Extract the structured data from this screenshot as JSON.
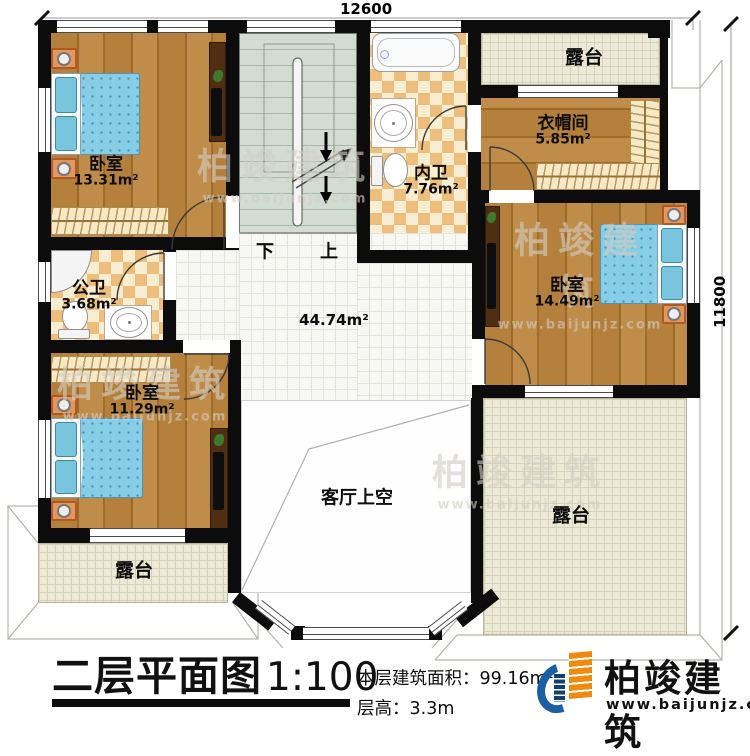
{
  "dimensions": {
    "width": "12600",
    "height": "11800"
  },
  "stairs": {
    "down": "下",
    "up": "上"
  },
  "rooms": {
    "bedroom_tl": {
      "name": "卧室",
      "area": "13.31m²"
    },
    "bath_inner": {
      "name": "内卫",
      "area": "7.76m²"
    },
    "terrace_top": {
      "name": "露台"
    },
    "cloakroom": {
      "name": "衣帽间",
      "area": "5.85m²"
    },
    "bedroom_r": {
      "name": "卧室",
      "area": "14.49m²"
    },
    "bath_public": {
      "name": "公卫",
      "area": "3.68m²"
    },
    "bedroom_bl": {
      "name": "卧室",
      "area": "11.29m²"
    },
    "hall": {
      "area": "44.74m²"
    },
    "living_void": {
      "name": "客厅上空"
    },
    "terrace_bl": {
      "name": "露台"
    },
    "terrace_br": {
      "name": "露台"
    }
  },
  "watermark": {
    "brand": "柏竣建筑",
    "url": "www.baijunjz.com"
  },
  "footer": {
    "title": "二层平面图",
    "scale": "1:100",
    "floor_area_label": "本层建筑面积：",
    "floor_area_value": "99.16m²",
    "floor_height_label": "层高：",
    "floor_height_value": "3.3m",
    "brand": "柏竣建筑",
    "brand_url": "www.baijunjz.com"
  },
  "colors": {
    "wall": "#0c0c0c",
    "wood": "#b07a36",
    "tile_warm": "#edbe7c",
    "stair": "#d3dcd2",
    "terrace": "#ecead6",
    "bed": "#87cde6",
    "brand_blue": "#1b5ea6",
    "brand_orange": "#f08a0e"
  }
}
